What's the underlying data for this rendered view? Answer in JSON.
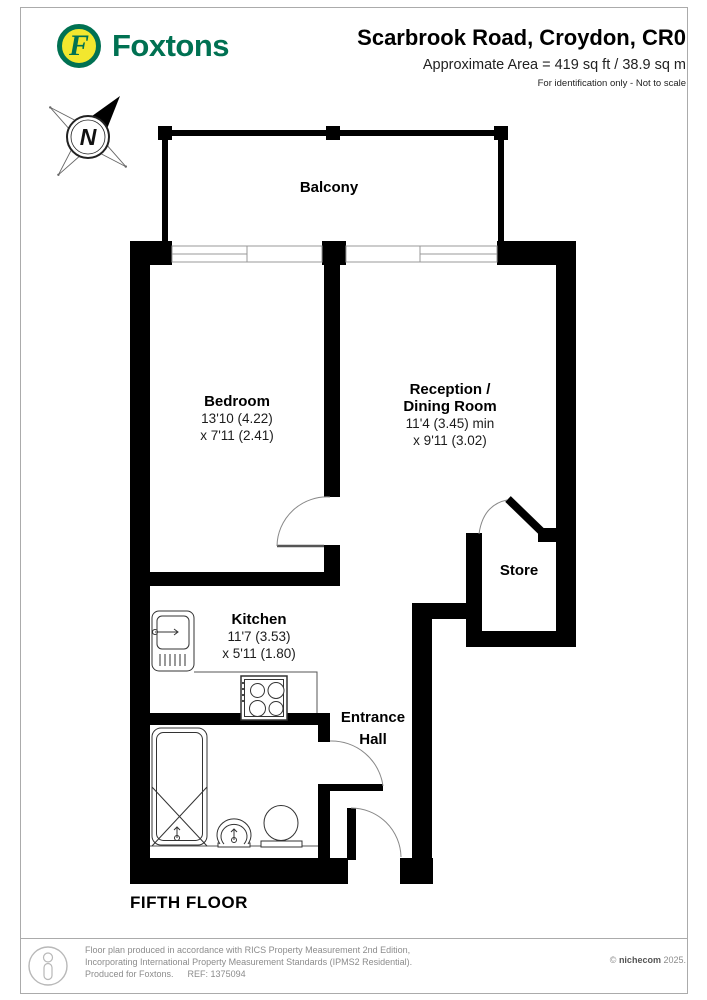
{
  "header": {
    "brand": "Foxtons",
    "logo_letter": "F",
    "title": "Scarbrook Road, Croydon, CR0",
    "area_line": "Approximate Area = 419 sq ft / 38.9 sq m",
    "note_line": "For identification only - Not to scale",
    "brand_color": "#007152",
    "logo_yellow": "#F2E72E"
  },
  "compass": {
    "north_label": "N"
  },
  "plan": {
    "balcony_label": "Balcony",
    "bedroom": {
      "name": "Bedroom",
      "dim_line1": "13'10 (4.22)",
      "dim_line2": "x 7'11 (2.41)"
    },
    "reception": {
      "name_line1": "Reception /",
      "name_line2": "Dining Room",
      "dim_line1": "11'4 (3.45) min",
      "dim_line2": "x 9'11 (3.02)"
    },
    "kitchen": {
      "name": "Kitchen",
      "dim_line1": "11'7 (3.53)",
      "dim_line2": "x 5'11 (1.80)"
    },
    "store_label": "Store",
    "entrance_hall": {
      "name_line1": "Entrance",
      "name_line2": "Hall"
    },
    "floor_label": "FIFTH FLOOR"
  },
  "footer": {
    "line1": "Floor plan produced in accordance with RICS Property Measurement 2nd Edition,",
    "line2": "Incorporating International Property Measurement Standards (IPMS2 Residential).",
    "line3": "Produced for Foxtons.",
    "ref": "REF: 1375094",
    "copyright_symbol": "©",
    "copyright_brand": "nichecom",
    "copyright_year": "2025."
  }
}
